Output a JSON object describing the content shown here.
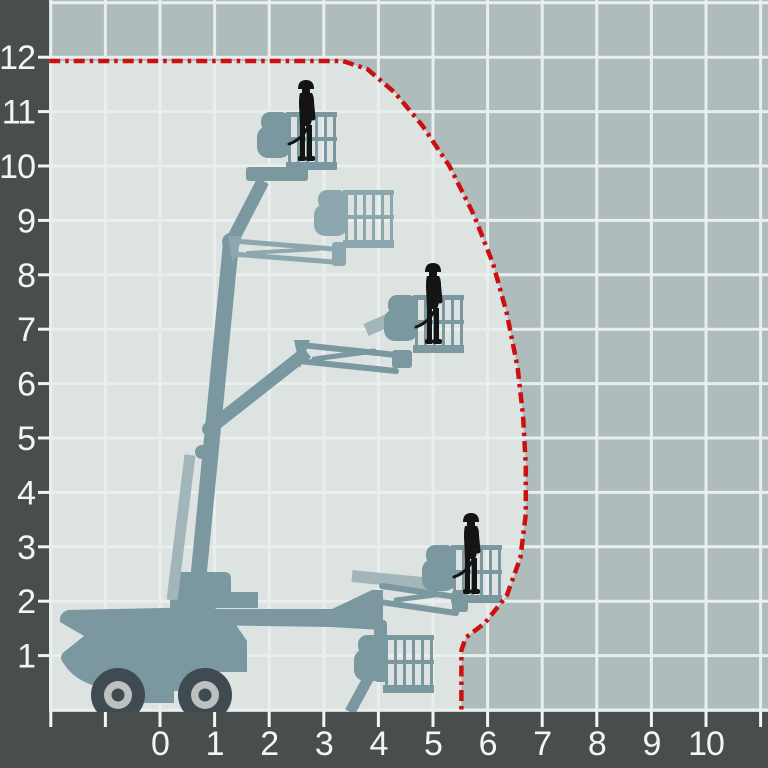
{
  "chart_data": {
    "type": "area",
    "title": "",
    "xlabel": "",
    "ylabel": "",
    "grid": true,
    "legend": {
      "visible": false
    },
    "x_axis": {
      "tick_labels": [
        "0",
        "1",
        "2",
        "3",
        "4",
        "5",
        "6",
        "7",
        "8",
        "9",
        "10"
      ],
      "tick_values": [
        0,
        1,
        2,
        3,
        4,
        5,
        6,
        7,
        8,
        9,
        10
      ],
      "grid_min": -2,
      "grid_max": 11,
      "step": 1
    },
    "y_axis": {
      "tick_labels": [
        "1",
        "2",
        "3",
        "4",
        "5",
        "6",
        "7",
        "8",
        "9",
        "10",
        "11",
        "12"
      ],
      "tick_values": [
        1,
        2,
        3,
        4,
        5,
        6,
        7,
        8,
        9,
        10,
        11,
        12
      ],
      "grid_min": 0,
      "grid_max": 13,
      "step": 1
    },
    "series": [
      {
        "name": "working-envelope-boundary",
        "style": "red-dash-dot",
        "points": [
          [
            -2.03,
            11.93
          ],
          [
            3.35,
            11.93
          ],
          [
            3.8,
            11.78
          ],
          [
            4.3,
            11.35
          ],
          [
            4.8,
            10.75
          ],
          [
            5.3,
            10.0
          ],
          [
            5.75,
            9.1
          ],
          [
            6.1,
            8.2
          ],
          [
            6.35,
            7.3
          ],
          [
            6.55,
            6.3
          ],
          [
            6.65,
            5.4
          ],
          [
            6.7,
            4.5
          ],
          [
            6.7,
            3.6
          ],
          [
            6.6,
            2.8
          ],
          [
            6.35,
            2.1
          ],
          [
            5.95,
            1.6
          ],
          [
            5.6,
            1.33
          ],
          [
            5.52,
            1.1
          ],
          [
            5.52,
            0
          ]
        ]
      }
    ],
    "annotations": {
      "max_platform_height": 11.93,
      "max_outreach": 6.7,
      "worker_positions": [
        {
          "x": 2.7,
          "y": 10.1
        },
        {
          "x": 5.0,
          "y": 6.5
        },
        {
          "x": 5.7,
          "y": 1.9
        }
      ],
      "basket_positions": [
        {
          "x": 2.6,
          "y": 10.1
        },
        {
          "x": 3.7,
          "y": 8.6
        },
        {
          "x": 5.0,
          "y": 6.6
        },
        {
          "x": 5.8,
          "y": 2.0
        },
        {
          "x": 4.5,
          "y": 0.3
        }
      ]
    }
  },
  "icons": {
    "machine": "boom-lift-silhouette",
    "person": "worker-in-basket-icon",
    "wheel": "wheel-icon"
  },
  "colors": {
    "axis_band": "#474e4d",
    "outside_envelope_bg": "#afbcbc",
    "inside_envelope_bg": "#dce3e1",
    "grid_line": "#e9efee",
    "envelope_line": "#cc1010",
    "machine_teal": "#7b98a0",
    "machine_ghost": "#a2b6ba",
    "machine_teal_light": "#8da7ae",
    "worker": "#141414",
    "tire": "#3f4a51",
    "wheel_ring": "#bcc0c1",
    "axis_label": "#f3f6f6"
  }
}
